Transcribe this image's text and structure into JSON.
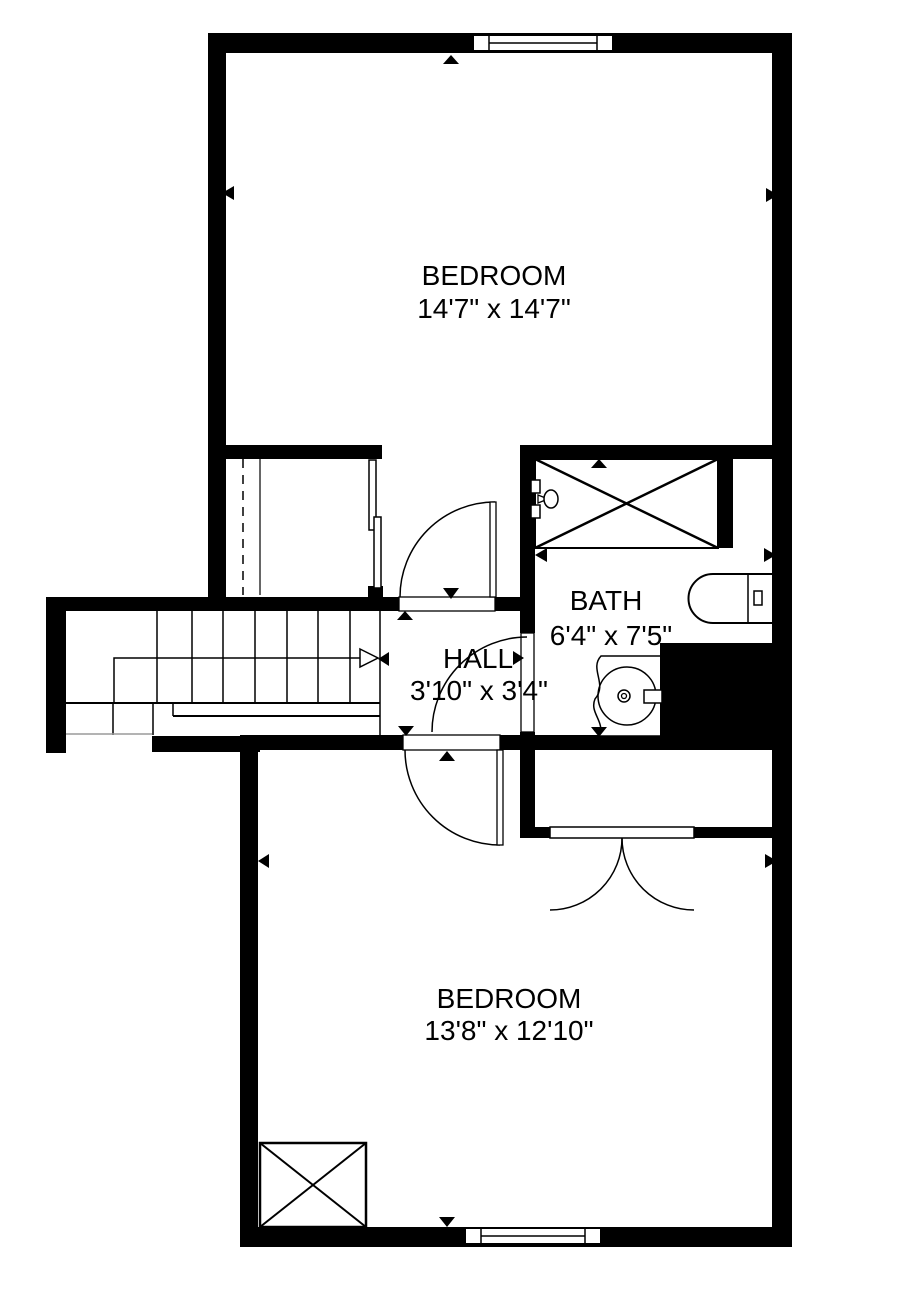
{
  "plan": {
    "type": "floor-plan",
    "rooms": {
      "bedroom1": {
        "name": "BEDROOM",
        "dims": "14'7\" x 14'7\""
      },
      "bath": {
        "name": "BATH",
        "dims": "6'4\" x 7'5\""
      },
      "hall": {
        "name": "HALL",
        "dims": "3'10\" x 3'4\""
      },
      "bedroom2": {
        "name": "BEDROOM",
        "dims": "13'8\" x 12'10\""
      }
    },
    "fixtures": [
      "staircase-with-up-arrow",
      "closet-sliding-doors",
      "shower-with-x-and-showerhead",
      "toilet",
      "sink-vanity",
      "closet-double-doors",
      "skylight-x-box",
      "window-top",
      "window-bottom"
    ],
    "colors": {
      "wall": "#000000",
      "background": "#ffffff",
      "linework": "#000000",
      "cutline": "#9a9a9a"
    }
  }
}
